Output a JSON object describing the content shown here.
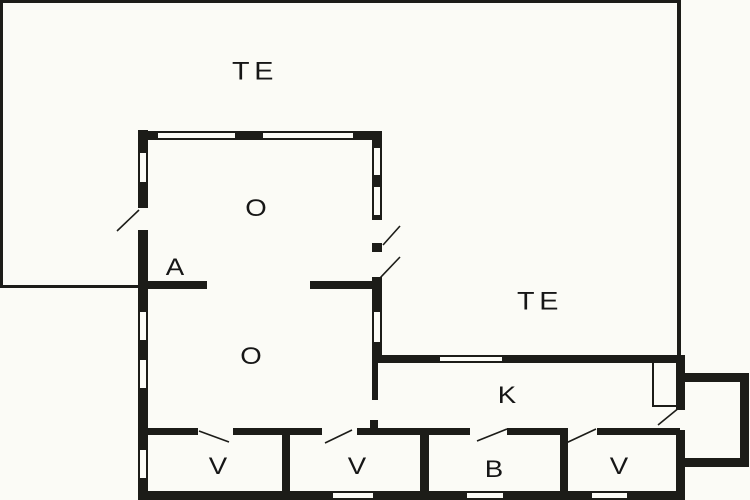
{
  "diagram_type": "floor-plan",
  "colors": {
    "background": "#fbfbf6",
    "wall": "#1c1c18",
    "label": "#161616"
  },
  "rooms": [
    {
      "id": "te-top",
      "label": "TE"
    },
    {
      "id": "te-right",
      "label": "TE"
    },
    {
      "id": "o-upper",
      "label": "O"
    },
    {
      "id": "a",
      "label": "A"
    },
    {
      "id": "o-lower",
      "label": "O"
    },
    {
      "id": "k",
      "label": "K"
    },
    {
      "id": "v1",
      "label": "V"
    },
    {
      "id": "v2",
      "label": "V"
    },
    {
      "id": "b",
      "label": "B"
    },
    {
      "id": "v3",
      "label": "V"
    }
  ]
}
